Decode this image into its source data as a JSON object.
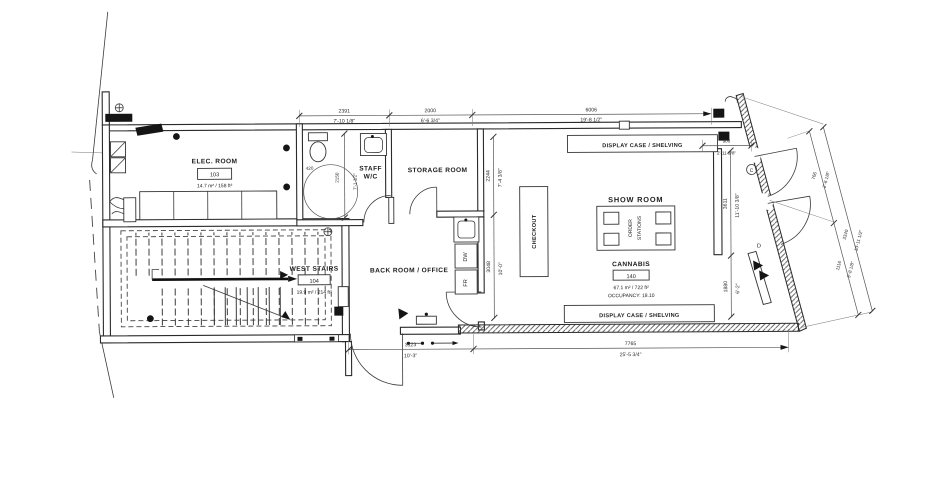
{
  "rooms": {
    "elec": {
      "name": "ELEC. ROOM",
      "number": "103",
      "area": "14.7 m² / 158 ft²"
    },
    "west_stairs": {
      "name": "WEST STAIRS",
      "number": "104",
      "area": "19.9 m² / 214 ft²"
    },
    "staff_wc": {
      "line1": "STAFF",
      "line2": "W/C"
    },
    "storage": {
      "name": "STORAGE ROOM"
    },
    "back_room": {
      "name": "BACK ROOM / OFFICE"
    },
    "show_room": {
      "name": "SHOW ROOM"
    },
    "cannabis": {
      "name": "CANNABIS",
      "number": "140",
      "area": "67.1 m² / 722 ft²",
      "occupancy": "OCCUPANCY: 18.10"
    }
  },
  "fixtures": {
    "checkout": "CHECKOUT",
    "order_line1": "ORDER",
    "order_line2": "STATIONS",
    "dishwasher": "DW",
    "fridge": "FR",
    "display_case_top": "DISPLAY CASE / SHELVING",
    "display_case_bottom": "DISPLAY CASE / SHELVING"
  },
  "door_tags": {
    "c": "C",
    "d": "D"
  },
  "dimensions": {
    "top": [
      {
        "mm": "2391",
        "ft": "7'-10 1/8\""
      },
      {
        "mm": "2000",
        "ft": "6'-6 3/4\""
      },
      {
        "mm": "6006",
        "ft": "19'-8 1/2\""
      }
    ],
    "bottom": [
      {
        "mm": "3123",
        "ft": "10'-3\""
      },
      {
        "mm": "7765",
        "ft": "25'-5 3/4\""
      }
    ],
    "interior": [
      {
        "mm": "2244",
        "ft": "7'-4 3/8\""
      },
      {
        "mm": "3048",
        "ft": "10'-0\""
      }
    ],
    "showroom_wall": {
      "mm": "900",
      "ft": "2'-11 3/8\""
    },
    "fin": [
      {
        "mm": "3611",
        "ft": "11'-10 3/8\""
      },
      {
        "mm": "1880",
        "ft": "6'-2\""
      }
    ],
    "right": [
      {
        "mm": "766",
        "ft": "2'-6 1/8\""
      },
      {
        "mm": "1116",
        "ft": "3'-8 1/8\""
      },
      {
        "mm": "3340",
        "ft": "10'-11 1/2\""
      }
    ],
    "wc": {
      "mm": "2150",
      "ft": "7'-1 1/2\"",
      "toilet": "420"
    }
  }
}
